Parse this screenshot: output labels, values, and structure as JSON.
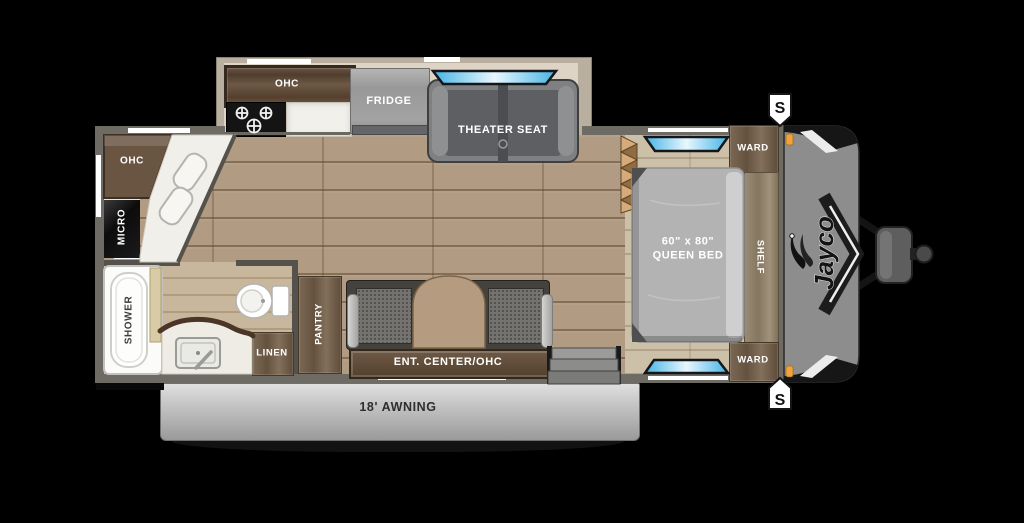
{
  "floorplan": {
    "brand": "Jayco",
    "labels": {
      "kitchen_ohc": "OHC",
      "fridge": "FRIDGE",
      "theater_seat": "THEATER SEAT",
      "galley_ohc": "OHC",
      "micro": "MICRO",
      "shower": "SHOWER",
      "linen": "LINEN",
      "pantry": "PANTRY",
      "ent_center": "ENT. CENTER/OHC",
      "bed_size": "60\" x 80\"",
      "bed_type": "QUEEN BED",
      "ward_front_top": "WARD",
      "ward_front_bottom": "WARD",
      "shelf": "SHELF",
      "awning": "18' AWNING",
      "marker_top": "S",
      "marker_bottom": "S"
    },
    "colors": {
      "window_blue": "#5ec7ee",
      "awning_gray": "#c0c0c0",
      "front_cap_gray": "#8d8d8d",
      "marker_light_orange": "#f0a23c",
      "floor_wood": "#b19b83",
      "bedroom_floor": "#cdc0a9",
      "cabinet_wood": "#6e5c4a",
      "wall_gray": "#6e6a64"
    }
  }
}
